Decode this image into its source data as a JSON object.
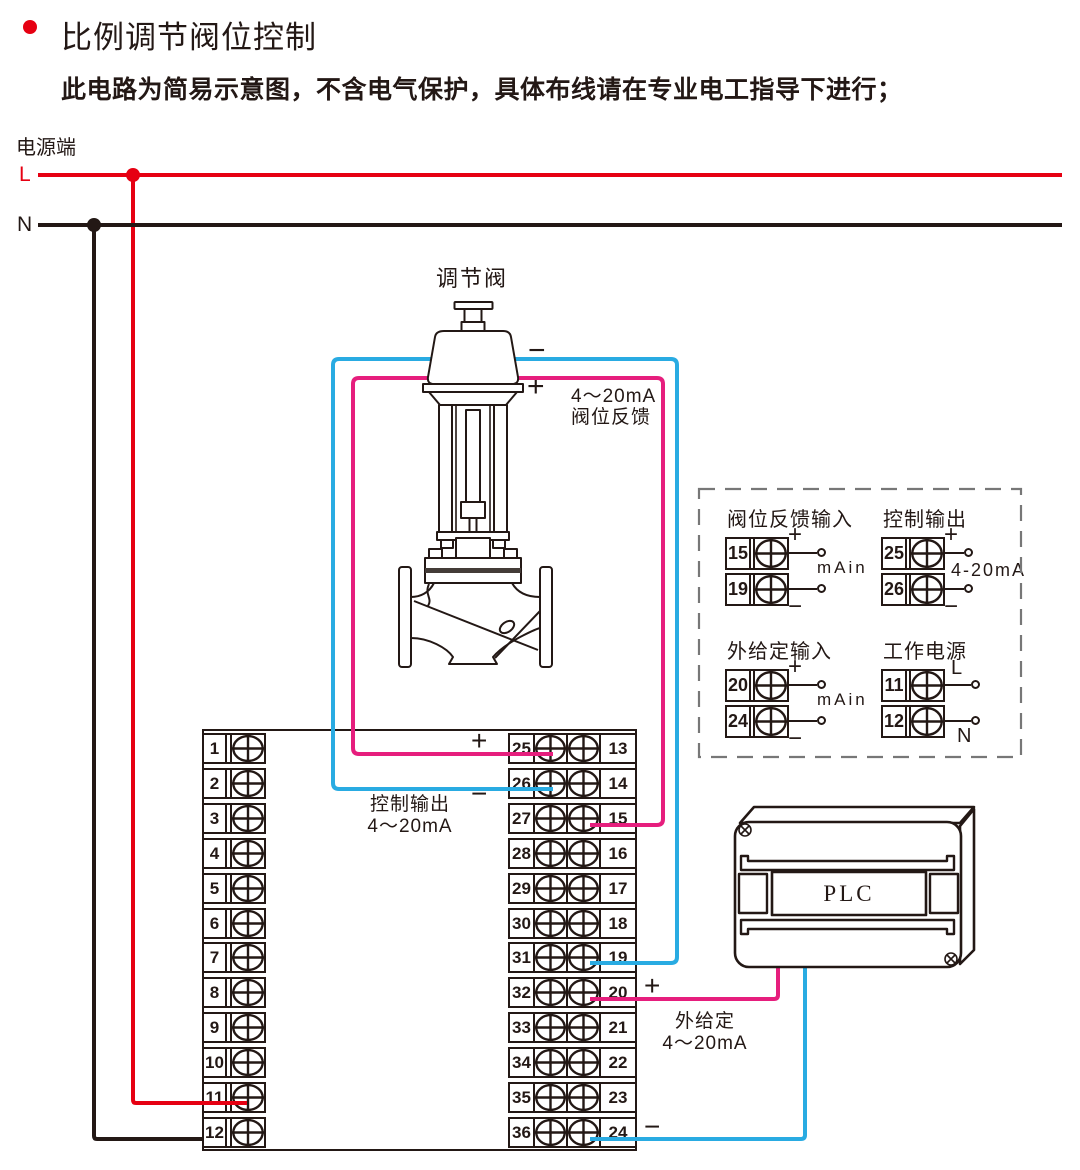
{
  "colors": {
    "ink": "#231815",
    "wire_red": "#e60012",
    "wire_black": "#231815",
    "wire_magenta": "#e61e7d",
    "wire_blue": "#29abe2",
    "bullet_red": "#e60012",
    "dash_gray": "#777777"
  },
  "header": {
    "title": "比例调节阀位控制",
    "subtitle": "此电路为简易示意图，不含电气保护，具体布线请在专业电工指导下进行；"
  },
  "power": {
    "label": "电源端",
    "live": "L",
    "neutral": "N"
  },
  "valve": {
    "name": "调节阀",
    "minus": "−",
    "plus": "+",
    "feedback_line1": "4～20mA",
    "feedback_line2": "阀位反馈"
  },
  "control_output": {
    "plus": "+",
    "minus": "−",
    "line1": "控制输出",
    "line2": "4～20mA"
  },
  "external_setpoint": {
    "plus": "+",
    "minus": "−",
    "line1": "外给定",
    "line2": "4～20mA"
  },
  "plc": {
    "label": "PLC"
  },
  "left_strip": {
    "terminals": [
      "1",
      "2",
      "3",
      "4",
      "5",
      "6",
      "7",
      "8",
      "9",
      "10",
      "11",
      "12"
    ]
  },
  "right_strip": {
    "left_terminals": [
      "25",
      "26",
      "27",
      "28",
      "29",
      "30",
      "31",
      "32",
      "33",
      "34",
      "35",
      "36"
    ],
    "right_terminals": [
      "13",
      "14",
      "15",
      "16",
      "17",
      "18",
      "19",
      "20",
      "21",
      "22",
      "23",
      "24"
    ]
  },
  "legend": {
    "groups": [
      {
        "id": "feedback-input",
        "title": "阀位反馈输入",
        "rows": [
          {
            "num": "15",
            "sign": "+"
          },
          {
            "num": "19",
            "sign": "−"
          }
        ],
        "mid_label": "mAin"
      },
      {
        "id": "control-output",
        "title": "控制输出",
        "rows": [
          {
            "num": "25",
            "sign": "+"
          },
          {
            "num": "26",
            "sign": "−"
          }
        ],
        "mid_label": "4-20mA"
      },
      {
        "id": "external-setpoint-input",
        "title": "外给定输入",
        "rows": [
          {
            "num": "20",
            "sign": "+"
          },
          {
            "num": "24",
            "sign": "−"
          }
        ],
        "mid_label": "mAin"
      },
      {
        "id": "working-power",
        "title": "工作电源",
        "rows": [
          {
            "num": "11",
            "sign": "L"
          },
          {
            "num": "12",
            "sign": "N"
          }
        ],
        "mid_label": ""
      }
    ]
  }
}
